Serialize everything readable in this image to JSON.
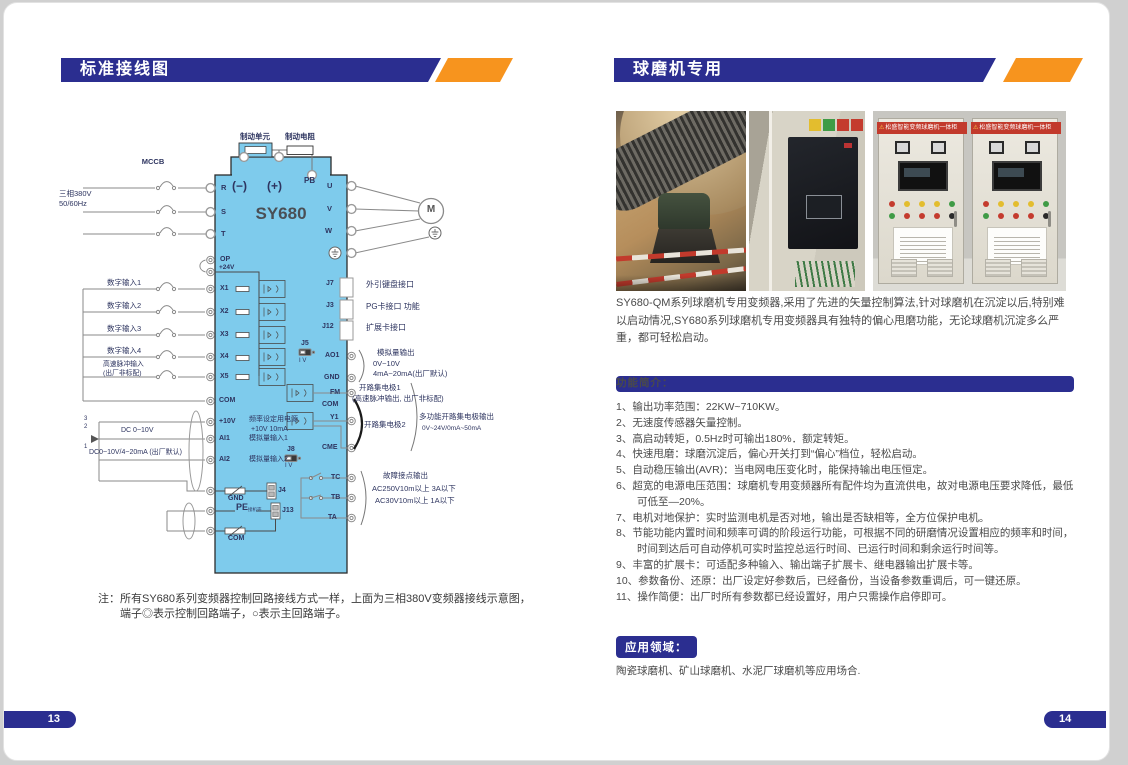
{
  "colors": {
    "navy": "#2b2e90",
    "orange": "#f7941e",
    "diagram_blue": "#7ecbec",
    "cabinet_banner_red": "#c23a2c"
  },
  "left_page": {
    "header": {
      "title": "标准接线图"
    },
    "page_number": "13",
    "note_line1": "注：所有SY680系列变频器控制回路接线方式一样，上面为三相380V变频器接线示意图，",
    "note_line2": "端子◎表示控制回路端子，○表示主回路端子。",
    "diagram": {
      "labels": [
        {
          "t": "制动单元",
          "x": 216,
          "y": 4,
          "s": 7.5,
          "b": 1,
          "c": 1
        },
        {
          "t": "制动电阻",
          "x": 261,
          "y": 4,
          "s": 7.5,
          "b": 1,
          "c": 1
        },
        {
          "t": "MCCB",
          "x": 114,
          "y": 29,
          "s": 7.5,
          "b": 1,
          "c": 1
        },
        {
          "t": "三相380V",
          "x": 20,
          "y": 61,
          "s": 7.5
        },
        {
          "t": "50/60Hz",
          "x": 20,
          "y": 71,
          "s": 7.5
        },
        {
          "t": "(−)",
          "x": 193,
          "y": 51,
          "s": 12,
          "b": 1
        },
        {
          "t": "(+)",
          "x": 228,
          "y": 51,
          "s": 12,
          "b": 1
        },
        {
          "t": "PB",
          "x": 265,
          "y": 48,
          "s": 8,
          "b": 1
        },
        {
          "t": "SY680",
          "x": 242,
          "y": 76,
          "s": 17,
          "b": 1,
          "c": 1,
          "col": "#4a4f55"
        },
        {
          "t": "R",
          "x": 182,
          "y": 55,
          "s": 7.5,
          "b": 1
        },
        {
          "t": "S",
          "x": 182,
          "y": 79,
          "s": 7.5,
          "b": 1
        },
        {
          "t": "T",
          "x": 182,
          "y": 101,
          "s": 7.5,
          "b": 1
        },
        {
          "t": "OP",
          "x": 181,
          "y": 127,
          "s": 7,
          "b": 1
        },
        {
          "t": "+24V",
          "x": 180,
          "y": 136,
          "s": 6.5,
          "b": 1
        },
        {
          "t": "X1",
          "x": 181,
          "y": 156,
          "s": 7,
          "b": 1
        },
        {
          "t": "X2",
          "x": 181,
          "y": 179,
          "s": 7,
          "b": 1
        },
        {
          "t": "X3",
          "x": 181,
          "y": 202,
          "s": 7,
          "b": 1
        },
        {
          "t": "X4",
          "x": 181,
          "y": 224,
          "s": 7,
          "b": 1
        },
        {
          "t": "X5",
          "x": 181,
          "y": 244,
          "s": 7,
          "b": 1
        },
        {
          "t": "COM",
          "x": 180,
          "y": 268,
          "s": 7,
          "b": 1
        },
        {
          "t": "+10V",
          "x": 180,
          "y": 289,
          "s": 7,
          "b": 1
        },
        {
          "t": "频率设定用电源",
          "x": 210,
          "y": 287,
          "s": 7
        },
        {
          "t": "+10V  10mA",
          "x": 212,
          "y": 297,
          "s": 7
        },
        {
          "t": "AI1",
          "x": 180,
          "y": 306,
          "s": 7,
          "b": 1
        },
        {
          "t": "模拟量输入1",
          "x": 210,
          "y": 306,
          "s": 7
        },
        {
          "t": "AI2",
          "x": 180,
          "y": 327,
          "s": 7,
          "b": 1
        },
        {
          "t": "模拟量输入2",
          "x": 210,
          "y": 327,
          "s": 7
        },
        {
          "t": "GND",
          "x": 189,
          "y": 366,
          "s": 7,
          "b": 1
        },
        {
          "t": "J4",
          "x": 239,
          "y": 358,
          "s": 7,
          "b": 1
        },
        {
          "t": "PE",
          "x": 197,
          "y": 374,
          "s": 9,
          "b": 1
        },
        {
          "t": "接机壳",
          "x": 209,
          "y": 379,
          "s": 4.5
        },
        {
          "t": "J13",
          "x": 243,
          "y": 378,
          "s": 7,
          "b": 1
        },
        {
          "t": "COM",
          "x": 189,
          "y": 406,
          "s": 7,
          "b": 1
        },
        {
          "t": "J5",
          "x": 262,
          "y": 211,
          "s": 7,
          "b": 1
        },
        {
          "t": "I  V",
          "x": 260,
          "y": 228.5,
          "s": 6
        },
        {
          "t": "J8",
          "x": 248,
          "y": 317,
          "s": 7,
          "b": 1
        },
        {
          "t": "I  V",
          "x": 246,
          "y": 334,
          "s": 6
        },
        {
          "t": "U",
          "x": 288,
          "y": 53,
          "s": 7.5,
          "b": 1
        },
        {
          "t": "V",
          "x": 288,
          "y": 76,
          "s": 7.5,
          "b": 1
        },
        {
          "t": "W",
          "x": 286,
          "y": 98,
          "s": 7.5,
          "b": 1
        },
        {
          "t": "J7",
          "x": 287,
          "y": 151,
          "s": 7,
          "b": 1
        },
        {
          "t": "J3",
          "x": 287,
          "y": 173,
          "s": 7,
          "b": 1
        },
        {
          "t": "J12",
          "x": 283,
          "y": 194,
          "s": 7,
          "b": 1
        },
        {
          "t": "AO1",
          "x": 286,
          "y": 223,
          "s": 7,
          "b": 1
        },
        {
          "t": "GND",
          "x": 285,
          "y": 245,
          "s": 7,
          "b": 1
        },
        {
          "t": "FM",
          "x": 291,
          "y": 260,
          "s": 7,
          "b": 1
        },
        {
          "t": "COM",
          "x": 283,
          "y": 272,
          "s": 7,
          "b": 1
        },
        {
          "t": "Y1",
          "x": 291,
          "y": 285,
          "s": 7,
          "b": 1
        },
        {
          "t": "CME",
          "x": 283,
          "y": 315,
          "s": 7,
          "b": 1
        },
        {
          "t": "TC",
          "x": 292,
          "y": 345,
          "s": 7,
          "b": 1
        },
        {
          "t": "TB",
          "x": 292,
          "y": 365,
          "s": 7,
          "b": 1
        },
        {
          "t": "TA",
          "x": 289,
          "y": 385,
          "s": 7,
          "b": 1
        },
        {
          "t": "M",
          "x": 392,
          "y": 76,
          "s": 10,
          "b": 1,
          "c": 1,
          "col": "#555"
        },
        {
          "t": "外引键盘接口",
          "x": 327,
          "y": 152,
          "s": 8
        },
        {
          "t": "PG卡接口 功能",
          "x": 327,
          "y": 174,
          "s": 8
        },
        {
          "t": "扩展卡接口",
          "x": 327,
          "y": 195,
          "s": 8
        },
        {
          "t": "模拟量输出",
          "x": 338,
          "y": 220,
          "s": 7.5
        },
        {
          "t": "0V~10V",
          "x": 334,
          "y": 231,
          "s": 7.5
        },
        {
          "t": "4mA~20mA(出厂默认)",
          "x": 334,
          "y": 241,
          "s": 7.5
        },
        {
          "t": "开路集电极1",
          "x": 320,
          "y": 255,
          "s": 7.5
        },
        {
          "t": "(高速脉冲输出, 出厂非标配)",
          "x": 313,
          "y": 266,
          "s": 7.5
        },
        {
          "t": "开路集电极2",
          "x": 325,
          "y": 292,
          "s": 7.5
        },
        {
          "t": "多功能开路集电极输出",
          "x": 380,
          "y": 284,
          "s": 7.5
        },
        {
          "t": "0V~24V/0mA~50mA",
          "x": 383,
          "y": 297,
          "s": 6.5
        },
        {
          "t": "故障接点输出",
          "x": 344,
          "y": 343,
          "s": 7.5
        },
        {
          "t": "AC250V10m以上 3A以下",
          "x": 333,
          "y": 356,
          "s": 7.5
        },
        {
          "t": "AC30V10m以上 1A以下",
          "x": 336,
          "y": 368,
          "s": 7.5
        },
        {
          "t": "数字输入1",
          "x": 68,
          "y": 150,
          "s": 7.5
        },
        {
          "t": "数字输入2",
          "x": 68,
          "y": 173,
          "s": 7.5
        },
        {
          "t": "数字输入3",
          "x": 68,
          "y": 196,
          "s": 7.5
        },
        {
          "t": "数字输入4",
          "x": 68,
          "y": 218,
          "s": 7.5
        },
        {
          "t": "高速脉冲输入",
          "x": 64,
          "y": 232,
          "s": 6.8
        },
        {
          "t": "(出厂非标配)",
          "x": 64,
          "y": 241,
          "s": 6.8
        },
        {
          "t": "DC 0~10V",
          "x": 82,
          "y": 298,
          "s": 7
        },
        {
          "t": "DC0~10V/4~20mA (出厂默认)",
          "x": 50,
          "y": 320,
          "s": 7
        },
        {
          "t": "3",
          "x": 45,
          "y": 287,
          "s": 6
        },
        {
          "t": "2",
          "x": 45,
          "y": 295,
          "s": 6
        },
        {
          "t": "1",
          "x": 45,
          "y": 315,
          "s": 6
        }
      ]
    }
  },
  "right_page": {
    "header": {
      "title": "球磨机专用"
    },
    "page_number": "14",
    "photos": {
      "cabinet_banner": "松盛智能变频球磨机一体柜",
      "warning_glyph": "⚠"
    },
    "intro": "SY680-QM系列球磨机专用变频器,采用了先进的矢量控制算法,针对球磨机在沉淀以后,特别难以启动情况,SY680系列球磨机专用变频器具有独特的偏心甩磨功能，无论球磨机沉淀多么严重，都可轻松启动。",
    "features_title": "功能简介：",
    "features": [
      "1、输出功率范围：22KW~710KW。",
      "2、无速度传感器矢量控制。",
      "3、高启动转矩，0.5Hz时可输出180%．额定转矩。",
      "4、快速甩磨：球磨沉淀后，偏心开关打到“偏心”档位，轻松启动。",
      "5、自动稳压输出(AVR)：当电网电压变化时，能保持输出电压恒定。",
      "6、超宽的电源电压范围：球磨机专用变频器所有配件均为直流供电，故对电源电压要求降低，最低可低至—20%。",
      "7、电机对地保护：实时监测电机是否对地，输出是否缺相等，全方位保护电机。",
      "8、节能功能内置时间和频率可调的阶段运行功能，可根据不同的研磨情况设置相应的频率和时间，时间到达后可自动停机可实时监控总运行时间、已运行时间和剩余运行时间等。",
      "9、丰富的扩展卡：可适配多种输入、输出端子扩展卡、继电器输出扩展卡等。",
      "10、参数备份、还原：出厂设定好参数后，已经备份，当设备参数重调后，可一键还原。",
      "11、操作简便：出厂时所有参数都已经设置好，用户只需操作启停即可。"
    ],
    "applications_title": "应用领域：",
    "applications": "陶瓷球磨机、矿山球磨机、水泥厂球磨机等应用场合."
  }
}
